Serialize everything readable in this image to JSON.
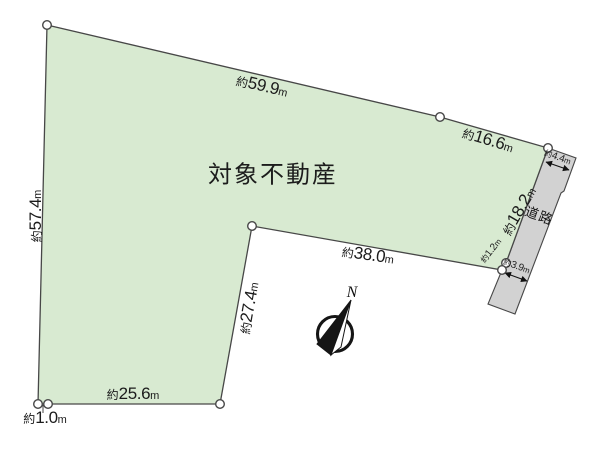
{
  "title": {
    "text": "対象不動産"
  },
  "road": {
    "label": "道路"
  },
  "compass": {
    "label": "N"
  },
  "colors": {
    "land_fill": "#d8ead1",
    "road_fill": "#d2d2d2",
    "line": "#474747",
    "text": "#1b1b1b"
  },
  "dimensions": {
    "top_long": {
      "prefix": "約",
      "value": "59.9",
      "unit": "m"
    },
    "top_short": {
      "prefix": "約",
      "value": "16.6",
      "unit": "m"
    },
    "left": {
      "prefix": "約",
      "value": "57.4",
      "unit": "m"
    },
    "right_frontage": {
      "prefix": "約",
      "value": "18.2",
      "unit": "m"
    },
    "road_width_top": {
      "prefix": "約",
      "value": "4.4",
      "unit": "m"
    },
    "right_jog": {
      "prefix": "約",
      "value": "1.2",
      "unit": "m"
    },
    "road_width_bottom": {
      "prefix": "約",
      "value": "3.9",
      "unit": "m"
    },
    "middle": {
      "prefix": "約",
      "value": "38.0",
      "unit": "m"
    },
    "inner_vertical": {
      "prefix": "約",
      "value": "27.4",
      "unit": "m"
    },
    "bottom": {
      "prefix": "約",
      "value": "25.6",
      "unit": "m"
    },
    "bottom_left_jog": {
      "prefix": "約",
      "value": "1.0",
      "unit": "m"
    }
  }
}
